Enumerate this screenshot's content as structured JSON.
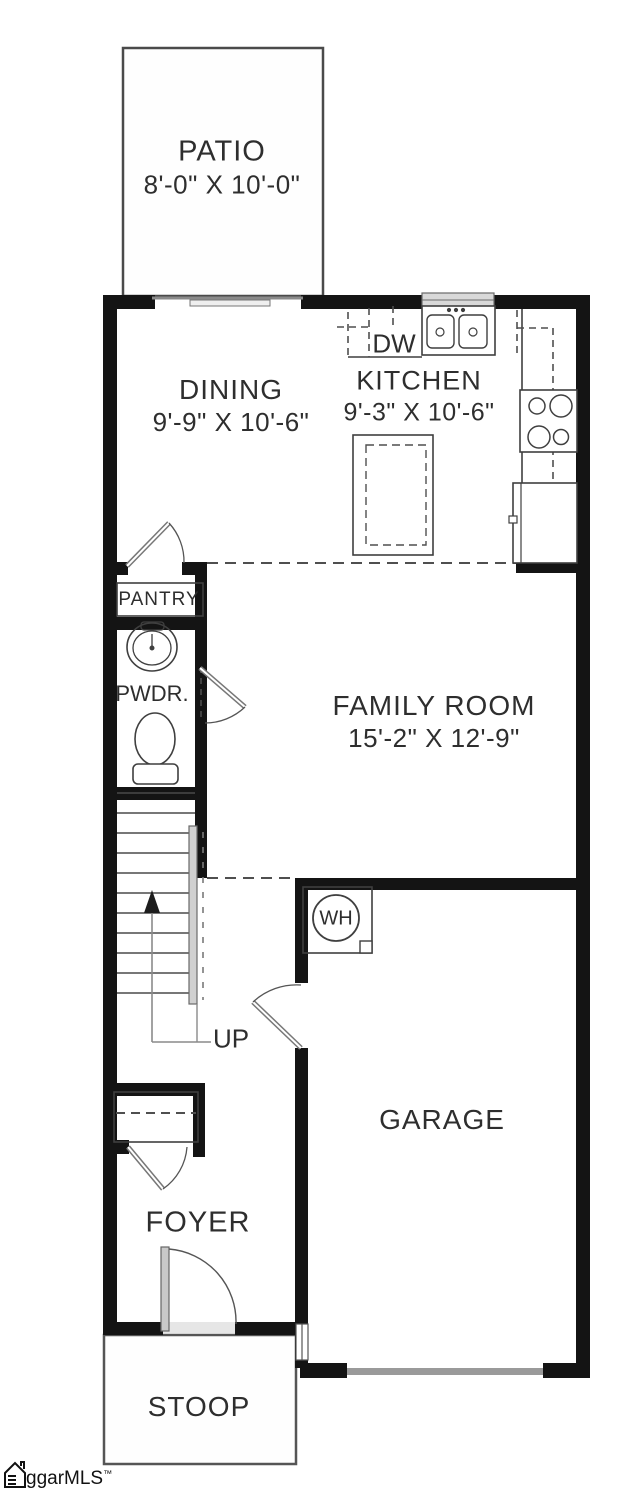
{
  "plan": {
    "rooms": {
      "patio": {
        "label": "PATIO",
        "dims": "8'-0\" X 10'-0\""
      },
      "dining": {
        "label": "DINING",
        "dims": "9'-9\" X 10'-6\""
      },
      "kitchen": {
        "label": "KITCHEN",
        "dims": "9'-3\" X 10'-6\""
      },
      "family": {
        "label": "FAMILY ROOM",
        "dims": "15'-2\" X 12'-9\""
      },
      "garage": {
        "label": "GARAGE"
      },
      "foyer": {
        "label": "FOYER"
      },
      "stoop": {
        "label": "STOOP"
      },
      "pantry": {
        "label": "PANTRY"
      },
      "powder": {
        "label": "PWDR."
      }
    },
    "annotations": {
      "dishwasher": "DW",
      "water_heater": "WH",
      "stairs_direction": "UP"
    },
    "watermark": {
      "text": "ggarMLS",
      "tm": "™"
    },
    "colors": {
      "wall": "#141414",
      "line": "#3f3f3f",
      "door_gray": "#9a9a9a",
      "text": "#2e2e2e"
    }
  }
}
